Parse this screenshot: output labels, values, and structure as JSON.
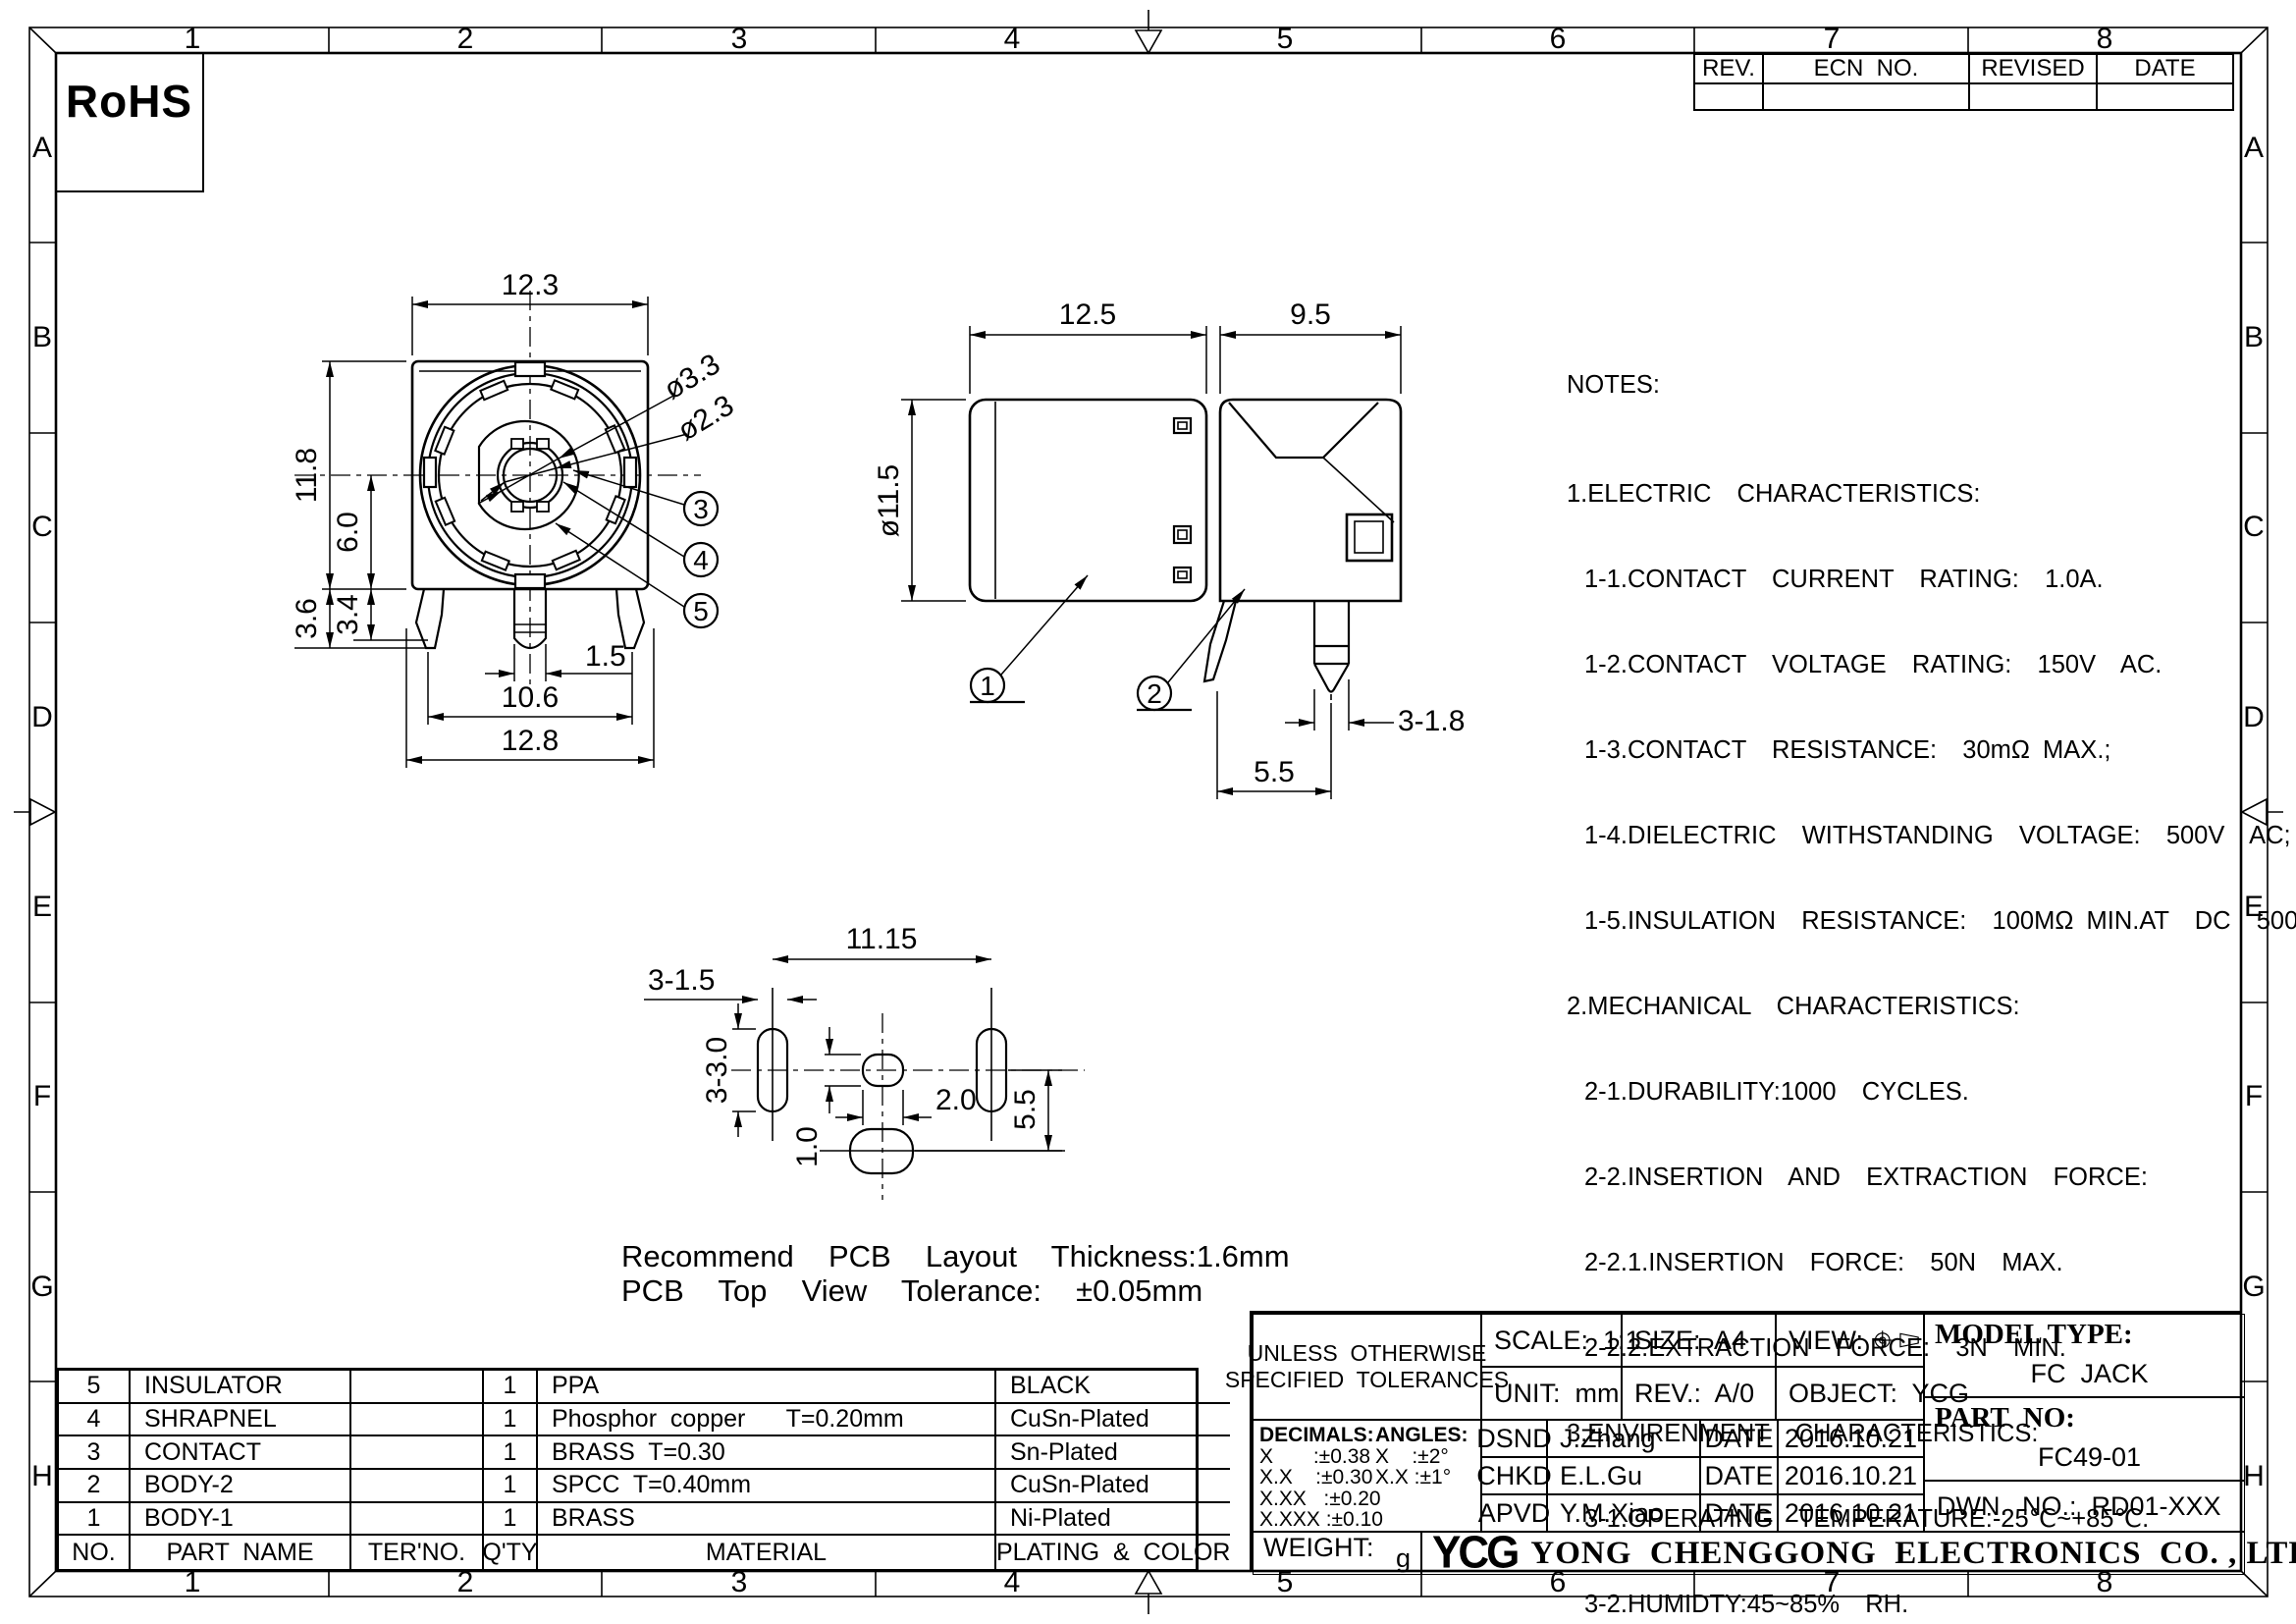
{
  "sheet": {
    "rohs": "RoHS",
    "border": {
      "cols": [
        "1",
        "2",
        "3",
        "4",
        "5",
        "6",
        "7",
        "8"
      ],
      "rows": [
        "A",
        "B",
        "C",
        "D",
        "E",
        "F",
        "G",
        "H"
      ]
    }
  },
  "rev_table": {
    "headers": [
      "REV.",
      "ECN  NO.",
      "REVISED",
      "DATE"
    ]
  },
  "notes": {
    "title": "NOTES:",
    "lines": [
      "1.ELECTRIC  CHARACTERISTICS:",
      "1-1.CONTACT  CURRENT  RATING:  1.0A.",
      "1-2.CONTACT  VOLTAGE  RATING:  150V  AC.",
      "1-3.CONTACT  RESISTANCE:  30mΩ MAX.;",
      "1-4.DIELECTRIC  WITHSTANDING  VOLTAGE:  500V  AC;",
      "1-5.INSULATION  RESISTANCE:  100MΩ MIN.AT  DC  500V.",
      "2.MECHANICAL  CHARACTERISTICS:",
      "2-1.DURABILITY:1000  CYCLES.",
      "2-2.INSERTION  AND  EXTRACTION  FORCE:",
      "2-2.1.INSERTION  FORCE:  50N  MAX.",
      "2-2.2.EXTRACTION  FORCE:  3N  MIN.",
      "3.ENVIRENMENT  CHARACTERISTICS:",
      "3-1.OPERATING  TEMPERATURE:-25℃~+85℃.",
      "3-2.HUMIDTY:45~85%  RH."
    ]
  },
  "views": {
    "front": {
      "dims": {
        "w_top": "12.3",
        "h_left": "11.8",
        "h_center": "6.0",
        "h_36": "3.6",
        "h_34": "3.4",
        "pin_w": "1.5",
        "w_mid": "10.6",
        "w_bot": "12.8",
        "d_outer": "ø3.3",
        "d_inner": "ø2.3"
      },
      "callouts": [
        "3",
        "4",
        "5"
      ]
    },
    "side": {
      "dims": {
        "w_left": "12.5",
        "w_right": "9.5",
        "d_body": "ø11.5",
        "pin": "3-1.8",
        "pitch": "5.5"
      },
      "callouts": [
        "1",
        "2"
      ]
    },
    "pcb": {
      "dims": {
        "span": "11.15",
        "slot_w": "3-1.5",
        "slot_h": "3-3.0",
        "pad_h": "1.0",
        "pad_w": "2.0",
        "pitch_v": "5.5"
      },
      "caption1": "Recommend  PCB  Layout  Thickness:1.6mm",
      "caption2": "PCB  Top  View  Tolerance:  ±0.05mm"
    }
  },
  "parts_table": {
    "headers": {
      "no": "NO.",
      "part_name": "PART  NAME",
      "ter_no": "TER'NO.",
      "qty": "Q'TY",
      "material": "MATERIAL",
      "plating": "PLATING  &  COLOR"
    },
    "rows": [
      {
        "no": "5",
        "name": "INSULATOR",
        "ter": "",
        "qty": "1",
        "material": "PPA",
        "plating": "BLACK"
      },
      {
        "no": "4",
        "name": "SHRAPNEL",
        "ter": "",
        "qty": "1",
        "material": "Phosphor  copper      T=0.20mm",
        "plating": "CuSn-Plated"
      },
      {
        "no": "3",
        "name": "CONTACT",
        "ter": "",
        "qty": "1",
        "material": "BRASS  T=0.30",
        "plating": "Sn-Plated"
      },
      {
        "no": "2",
        "name": "BODY-2",
        "ter": "",
        "qty": "1",
        "material": "SPCC  T=0.40mm",
        "plating": "CuSn-Plated"
      },
      {
        "no": "1",
        "name": "BODY-1",
        "ter": "",
        "qty": "1",
        "material": "BRASS",
        "plating": "Ni-Plated"
      }
    ]
  },
  "title_block": {
    "tol_header1": "UNLESS  OTHERWISE",
    "tol_header2": "SPECIFIED  TOLERANCES",
    "decimals_label": "DECIMALS:",
    "angles_label": "ANGLES:",
    "decimals": "X       :±0.38\nX.X    :±0.30\nX.XX   :±0.20\nX.XXX :±0.10",
    "angles": "X    :±2°\nX.X :±1°",
    "scale": "SCALE:  1:1",
    "size": "SIZE:  A4",
    "view_label": "VIEW:",
    "unit": "UNIT:  mm",
    "rev": "REV.:  A/0",
    "object": "OBJECT:  YCG",
    "model_type_label": "MODEL TYPE:",
    "model_type": "FC  JACK",
    "part_no_label": "PART  NO:",
    "part_no": "FC49-01",
    "dwn_no": "DWN.  NO.:  RD01-XXX",
    "sign_rows": [
      {
        "role": "DSND",
        "name": "J.Zhang",
        "date_label": "DATE",
        "date": "2016.10.21"
      },
      {
        "role": "CHKD",
        "name": "E.L.Gu",
        "date_label": "DATE",
        "date": "2016.10.21"
      },
      {
        "role": "APVD",
        "name": "Y.M.Xiao",
        "date_label": "DATE",
        "date": "2016.10.21"
      }
    ],
    "weight_label": "WEIGHT:",
    "weight_unit": "g",
    "logo": "YCG",
    "company": "YONG  CHENGGONG  ELECTRONICS  CO. , LTD."
  }
}
